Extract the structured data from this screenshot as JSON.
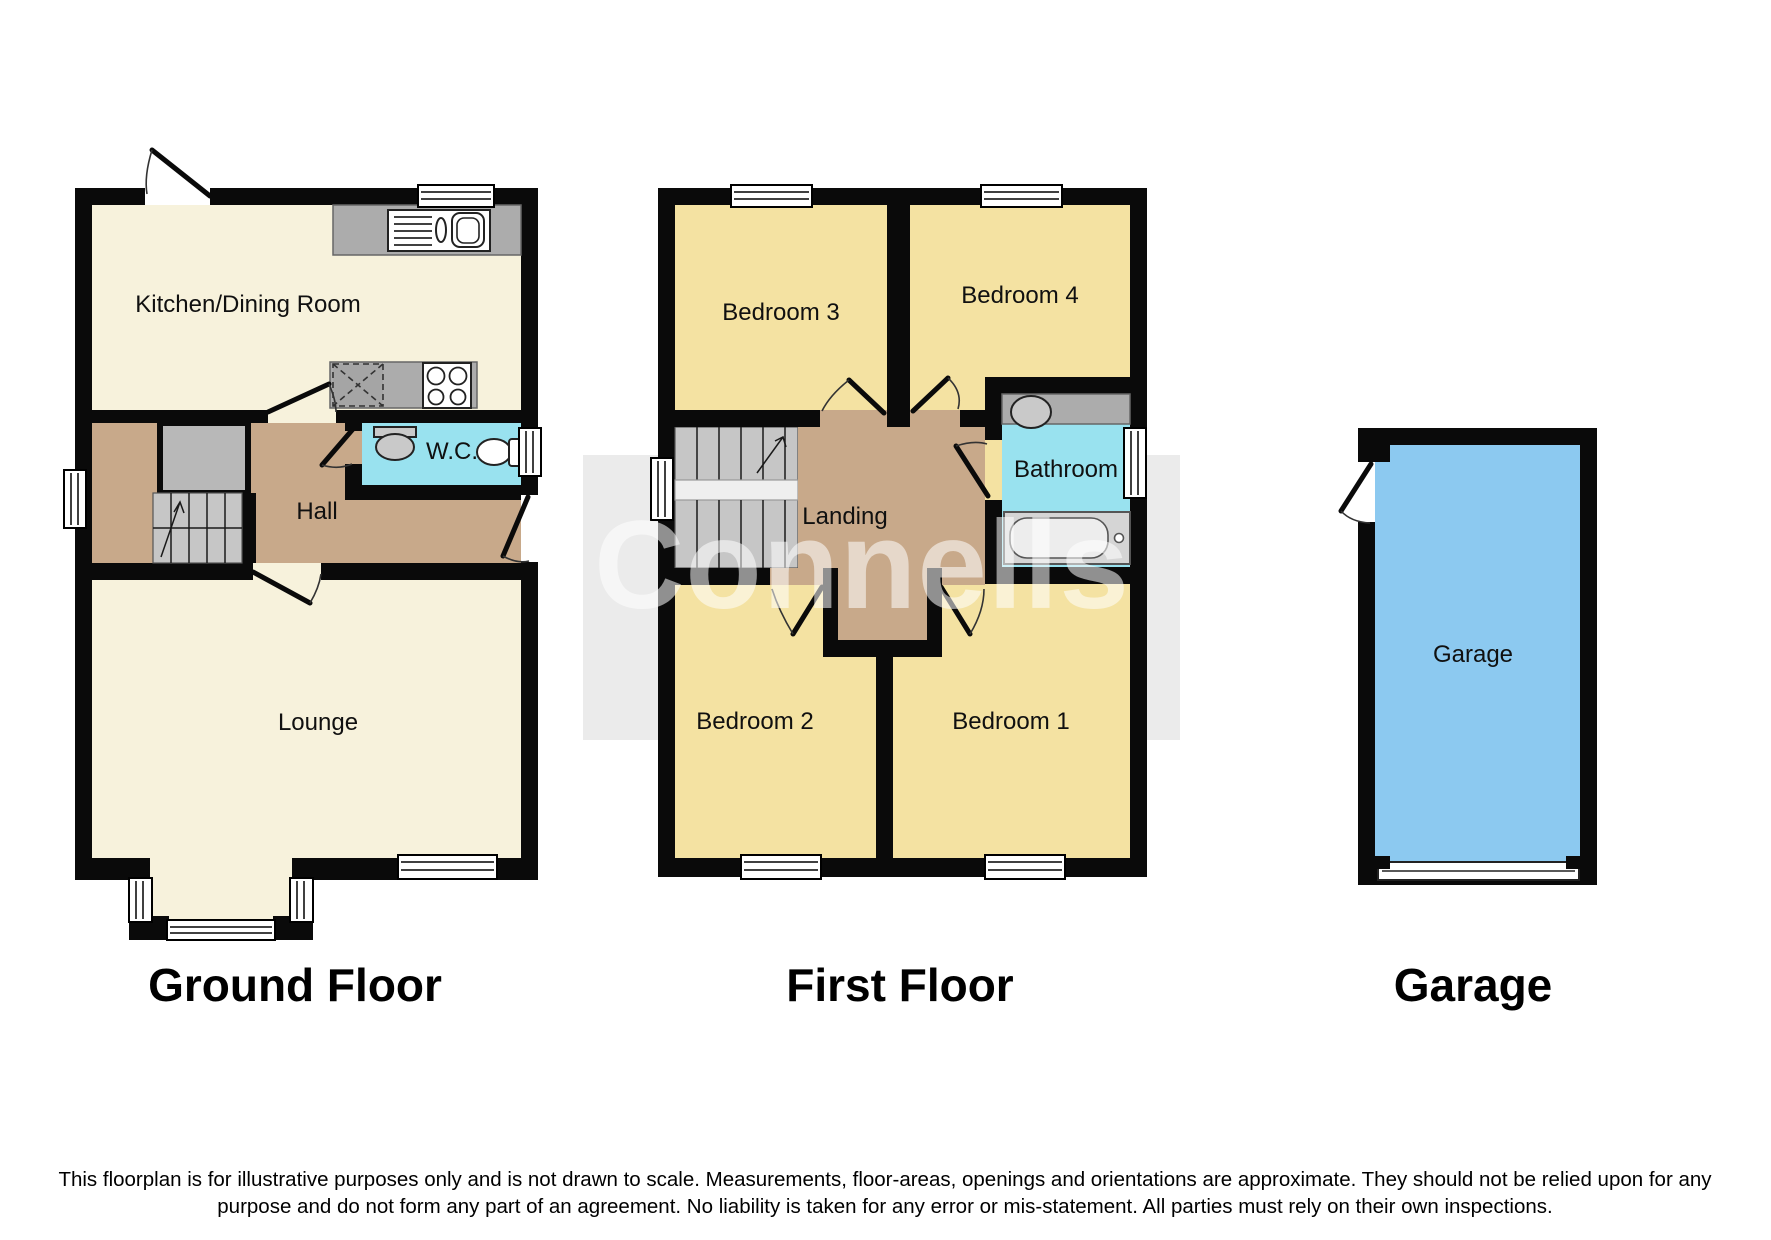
{
  "titles": {
    "ground": "Ground Floor",
    "first": "First Floor",
    "garage": "Garage"
  },
  "rooms": {
    "kitchen": "Kitchen/Dining Room",
    "hall": "Hall",
    "wc": "W.C.",
    "lounge": "Lounge",
    "bedroom3": "Bedroom 3",
    "bedroom4": "Bedroom 4",
    "bathroom": "Bathroom",
    "landing": "Landing",
    "bedroom2": "Bedroom 2",
    "bedroom1": "Bedroom 1",
    "garage": "Garage"
  },
  "watermark": {
    "text": "Connells"
  },
  "disclaimer": {
    "line1": "This floorplan is for illustrative purposes only and is not drawn to scale. Measurements, floor-areas, openings and orientations are approximate. They should not be relied upon for any",
    "line2": "purpose and do not form any part of an agreement. No liability is taken for any error or mis-statement. All parties must rely on their own inspections."
  },
  "colors": {
    "wall": "#0a0a0a",
    "cream_room": "#F7F2DC",
    "bedroom_yellow": "#F4E2A2",
    "hall_brown": "#C8A98A",
    "wet_room_cyan": "#99E2EF",
    "garage_blue": "#8CC9F0",
    "counter_gray": "#ACACAC",
    "stairs_gray": "#C6C6C6",
    "watermark_band": "rgba(0,0,0,0.08)",
    "garage_label": "#2b3a4a"
  }
}
